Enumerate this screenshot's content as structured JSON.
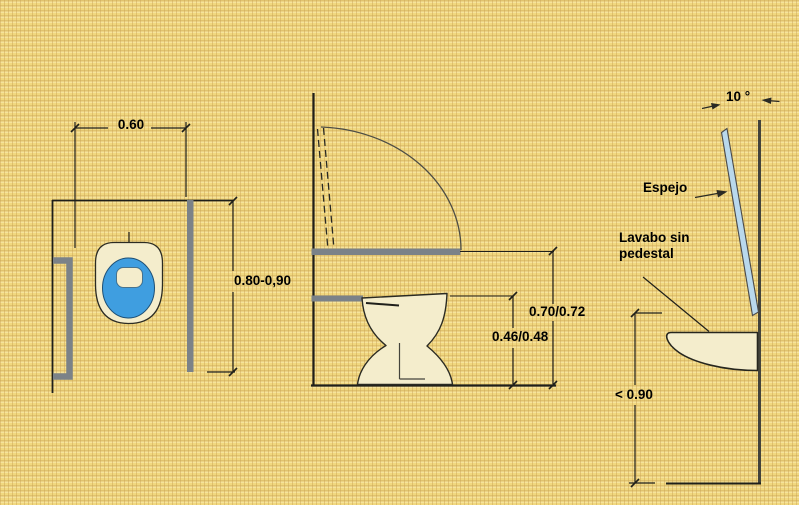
{
  "colors": {
    "bg": "#f1d87f",
    "line": "#1f1f1a",
    "cream": "#f4edcc",
    "bowl_blue": "#3f9ee0",
    "bar_gray": "#7b8288",
    "mirror_blue": "#b9d8ec",
    "wall_dark": "#43433b"
  },
  "plan_view": {
    "bars_separation": "0.60",
    "bar_length": "0.80-0,90"
  },
  "side_view": {
    "bar_height": "0.70/0.72",
    "seat_height": "0.46/0.48"
  },
  "mirror_sink_view": {
    "mirror_angle": "10 °",
    "mirror_label": "Espejo",
    "sink_label_line1": "Lavabo sin",
    "sink_label_line2": "pedestal",
    "sink_max_height": "< 0.90"
  }
}
